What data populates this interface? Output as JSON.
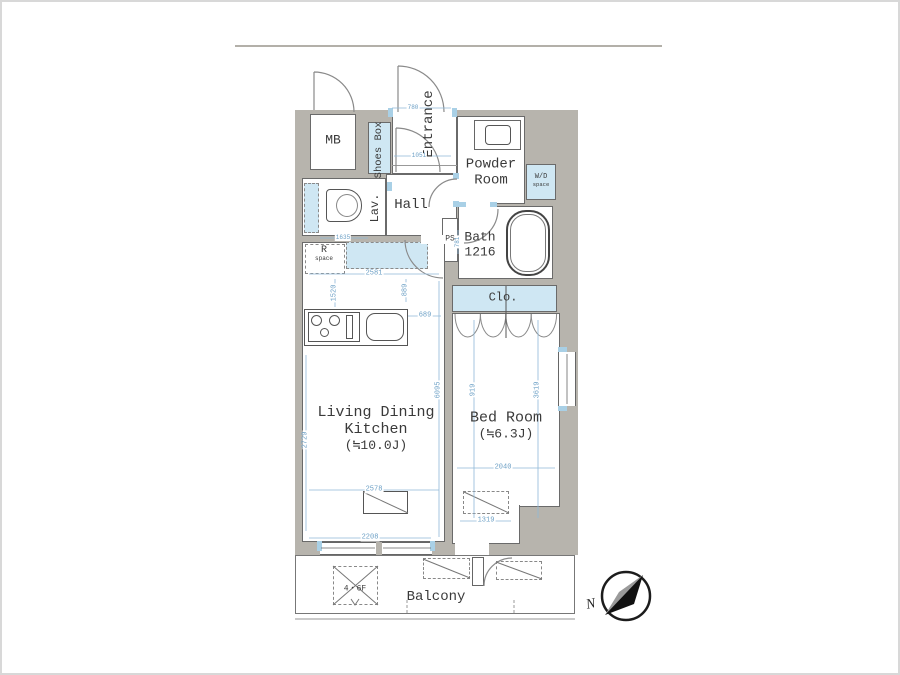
{
  "title": "Apartment floor plan",
  "colors": {
    "wall_gray": "#b7b4ad",
    "fixture_blue": "#cfe7f3",
    "dimension_blue": "#6b9fc5",
    "outline": "#6a6a6a"
  },
  "rooms": {
    "mb": "MB",
    "shoes_box": "Shoes Box",
    "entrance": "Entrance",
    "powder_room": [
      "Powder",
      "Room"
    ],
    "wd_space": [
      "W/D",
      "space"
    ],
    "bath": [
      "Bath",
      "1216"
    ],
    "ps": "PS",
    "lav": "Lav.",
    "hall": "Hall",
    "r_space": [
      "R",
      "space"
    ],
    "clo": "Clo.",
    "ldk": [
      "Living Dining",
      "Kitchen",
      "(≒10.0J)"
    ],
    "bedroom": [
      "Bed Room",
      "(≒6.3J)"
    ],
    "balcony": "Balcony",
    "floor_note": "4・6F"
  },
  "dims": [
    "780",
    "1051",
    "1635",
    "781",
    "2581",
    "1520",
    "889",
    "689",
    "6095",
    "2729",
    "2578",
    "2208",
    "919",
    "3619",
    "2040",
    "1319"
  ],
  "compass": {
    "label": "N"
  }
}
